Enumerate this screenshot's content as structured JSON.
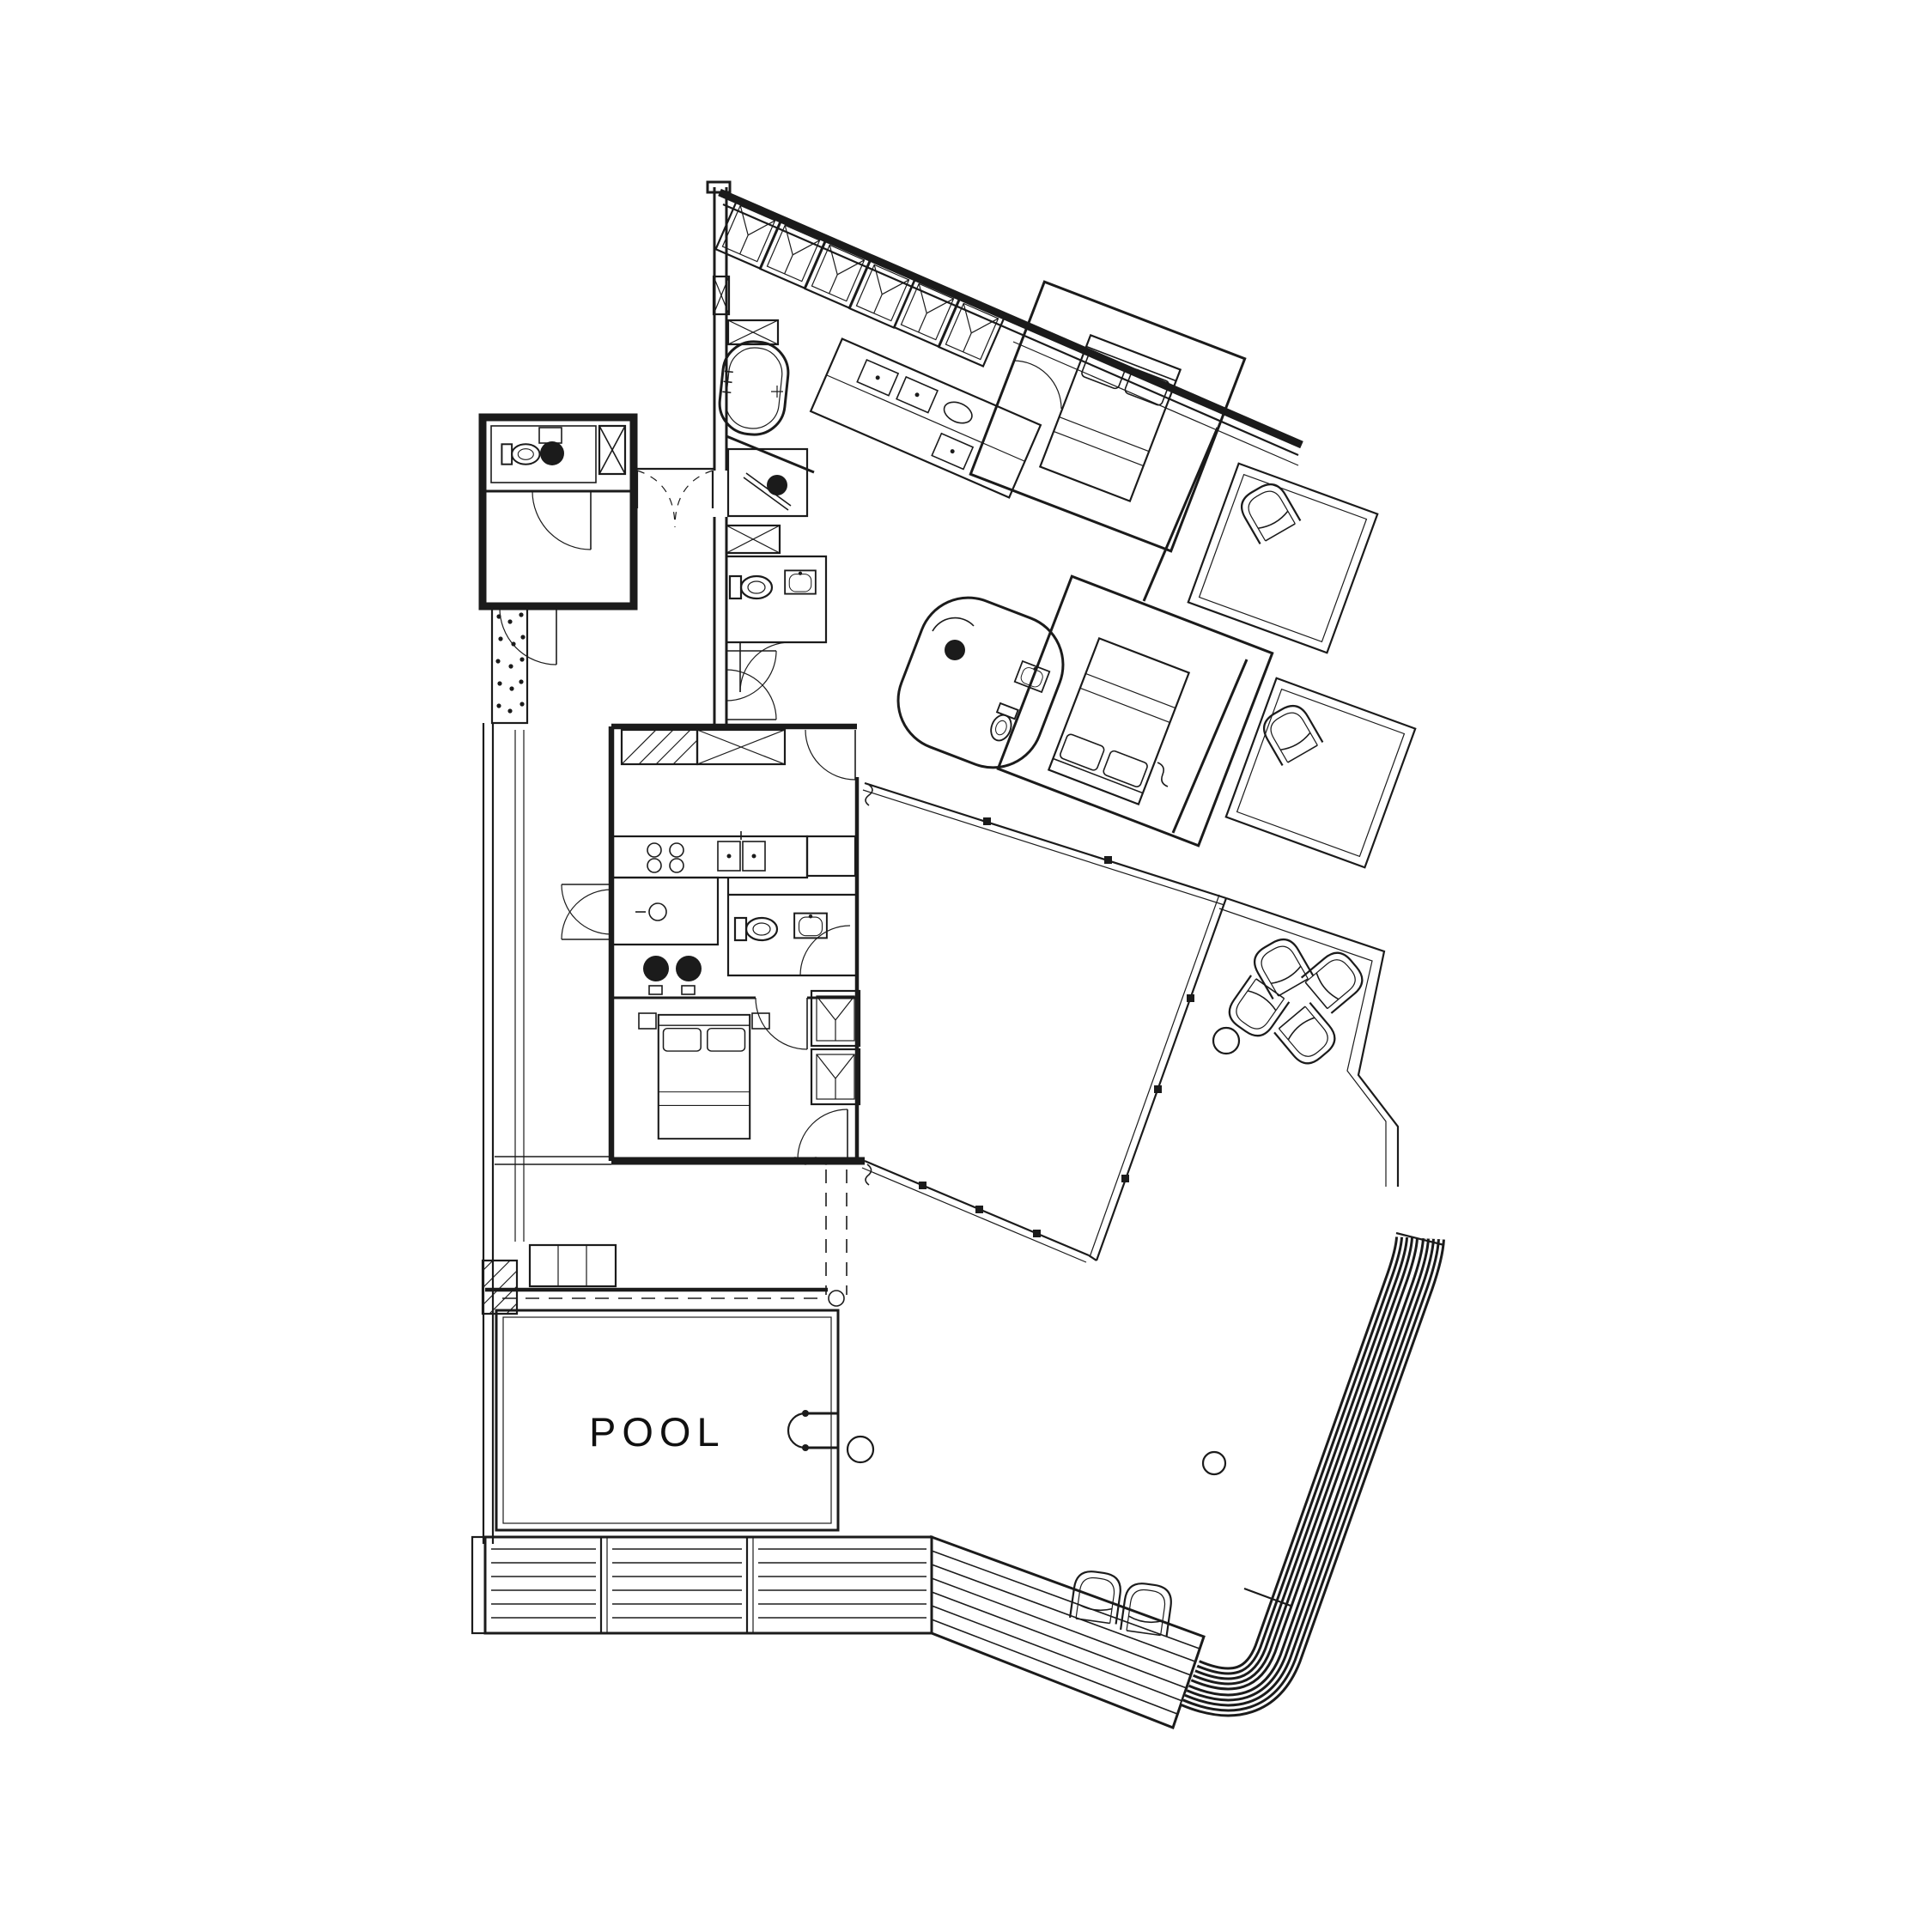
{
  "page": {
    "background_color": "#FFFFFF"
  },
  "plan": {
    "type": "architectural-floor-plan",
    "linework_color": "#1B1B1B",
    "pool": {
      "label": "POOL",
      "water_color": "#6CDBE0"
    },
    "icons": [
      "bathtub-icon",
      "shower-drain-icon",
      "toilet-icon",
      "washbasin-icon",
      "double-bed-icon",
      "wardrobe-icon",
      "armchair-icon",
      "washing-machine-icon",
      "cooktop-icon",
      "kitchen-sink-icon",
      "pool-ladder-icon",
      "round-table-icon",
      "door-swing-arc-icon",
      "duct-cross-icon",
      "deck-louver-band",
      "gravel-dots-icon"
    ]
  }
}
